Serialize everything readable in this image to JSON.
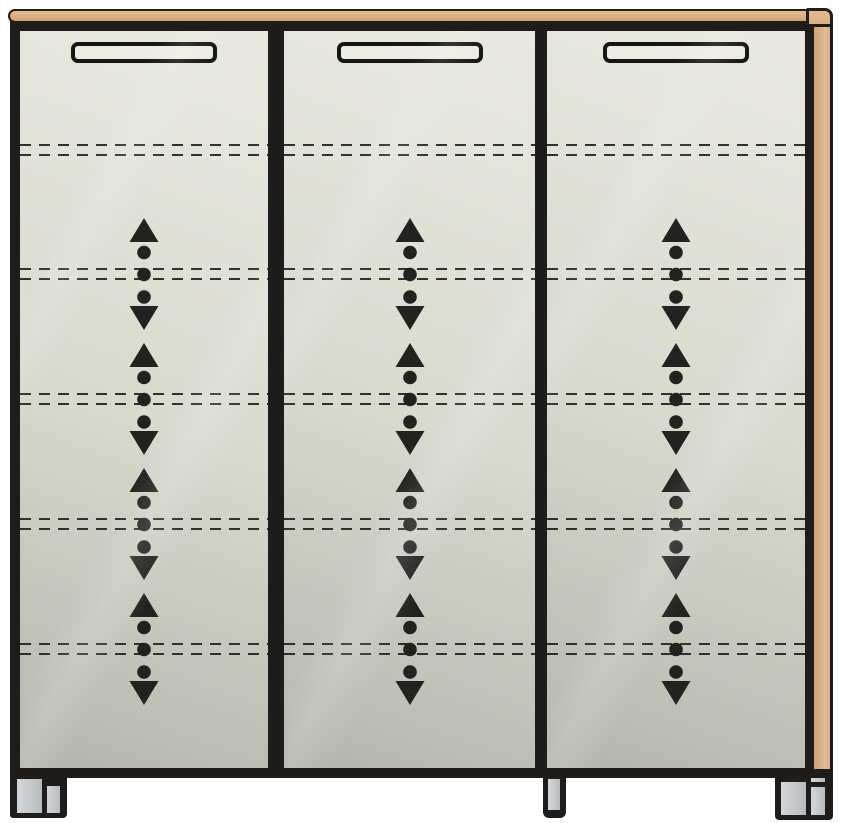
{
  "meta": {
    "kind": "technical-illustration",
    "subject": "Three-door cabinet front view with height-adjustable shelf markings",
    "canvas": {
      "width_px": 844,
      "height_px": 823
    }
  },
  "colors": {
    "background": "#ffffff",
    "frame": "#1f1d1b",
    "wood": "#d9ae82",
    "wood_light": "#e3bb90",
    "wood_dark": "#cfa276",
    "panel_light": "#e9e9e1",
    "panel_mid": "#d8d9cf",
    "panel_dark": "#b4b5ac",
    "marking": "#222220",
    "handle_fill": "#edece4",
    "foot_gray": "#c6c9cc"
  },
  "icons": {
    "up_arrow_icon": "triangle-up",
    "down_arrow_icon": "triangle-down",
    "dot_icon": "filled-circle"
  },
  "cabinet": {
    "top_panel": {
      "material": "wood",
      "has_right_end_cap": true
    },
    "side_panel_right": {
      "material": "wood"
    },
    "door_count": 3,
    "doors": [
      {
        "id": "door-1",
        "handle": "recessed-slot-handle"
      },
      {
        "id": "door-2",
        "handle": "recessed-slot-handle"
      },
      {
        "id": "door-3",
        "handle": "recessed-slot-handle"
      }
    ],
    "shelf_lines": {
      "count": 5,
      "style": "double-dashed",
      "center_offsets_pct_of_door_height": [
        16.15,
        32.97,
        49.93,
        66.89,
        83.85
      ]
    },
    "adjust_arrows": {
      "groups_per_door": 4,
      "pattern": [
        "up-arrow",
        "dot",
        "dot",
        "dot",
        "down-arrow"
      ],
      "center_offsets_pct_of_door_height": [
        32.97,
        49.93,
        66.89,
        83.85
      ]
    },
    "feet": {
      "count": 3,
      "positions": [
        "left",
        "center",
        "right"
      ],
      "left_and_right_style": "two-part-plate-and-leg",
      "center_style": "single-post"
    }
  }
}
